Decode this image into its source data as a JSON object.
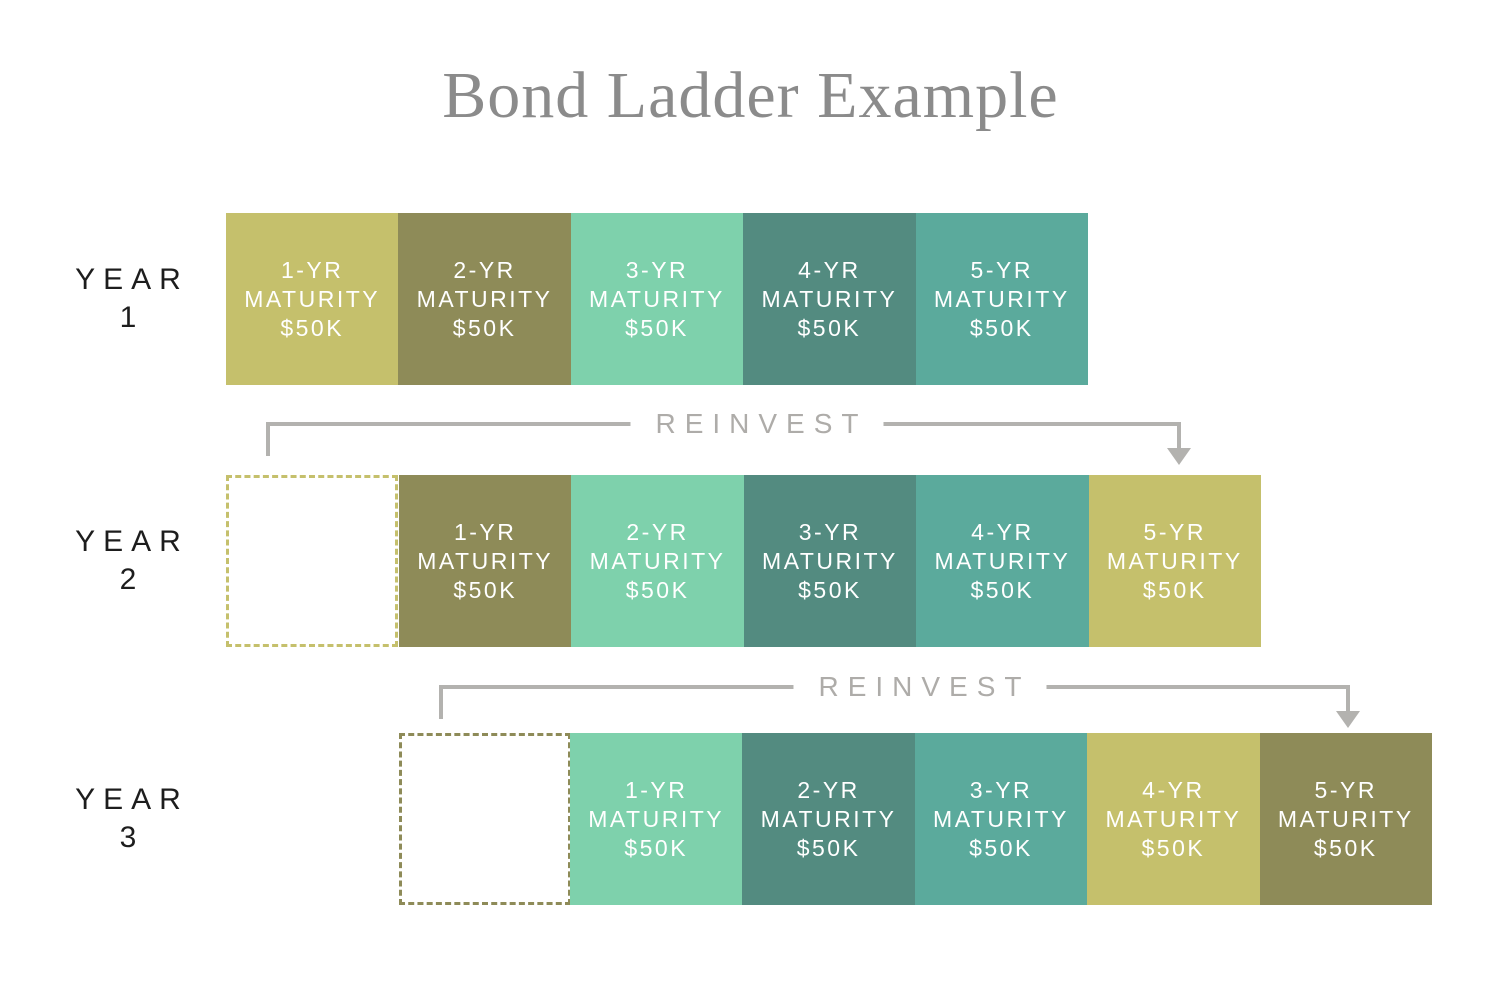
{
  "title": "Bond Ladder Example",
  "palette": {
    "khaki": "#c5c06c",
    "olive": "#8e8b58",
    "mint": "#7ed1ac",
    "teal_dark": "#538b80",
    "teal_medium": "#5baa9c",
    "arrow_gray": "#b3b2af",
    "reinvest_text_gray": "#aeaca9",
    "title_gray": "#8b8b8b",
    "year_label_color": "#1d1d1d",
    "block_text_color": "#ffffff",
    "background": "#ffffff"
  },
  "reinvest_arrows": [
    {
      "label": "REINVEST"
    },
    {
      "label": "REINVEST"
    }
  ],
  "years": [
    {
      "label": "YEAR",
      "number": "1",
      "blocks": [
        {
          "term": "1-YR",
          "maturity": "MATURITY",
          "amount": "$50K",
          "color": "#c5c06c"
        },
        {
          "term": "2-YR",
          "maturity": "MATURITY",
          "amount": "$50K",
          "color": "#8e8b58"
        },
        {
          "term": "3-YR",
          "maturity": "MATURITY",
          "amount": "$50K",
          "color": "#7ed1ac"
        },
        {
          "term": "4-YR",
          "maturity": "MATURITY",
          "amount": "$50K",
          "color": "#538b80"
        },
        {
          "term": "5-YR",
          "maturity": "MATURITY",
          "amount": "$50K",
          "color": "#5baa9c"
        }
      ]
    },
    {
      "label": "YEAR",
      "number": "2",
      "matured_box": {
        "border_color": "#c5c06c"
      },
      "blocks": [
        {
          "term": "1-YR",
          "maturity": "MATURITY",
          "amount": "$50K",
          "color": "#8e8b58"
        },
        {
          "term": "2-YR",
          "maturity": "MATURITY",
          "amount": "$50K",
          "color": "#7ed1ac"
        },
        {
          "term": "3-YR",
          "maturity": "MATURITY",
          "amount": "$50K",
          "color": "#538b80"
        },
        {
          "term": "4-YR",
          "maturity": "MATURITY",
          "amount": "$50K",
          "color": "#5baa9c"
        },
        {
          "term": "5-YR",
          "maturity": "MATURITY",
          "amount": "$50K",
          "color": "#c5c06c"
        }
      ]
    },
    {
      "label": "YEAR",
      "number": "3",
      "matured_box": {
        "border_color": "#8e8b58"
      },
      "blocks": [
        {
          "term": "1-YR",
          "maturity": "MATURITY",
          "amount": "$50K",
          "color": "#7ed1ac"
        },
        {
          "term": "2-YR",
          "maturity": "MATURITY",
          "amount": "$50K",
          "color": "#538b80"
        },
        {
          "term": "3-YR",
          "maturity": "MATURITY",
          "amount": "$50K",
          "color": "#5baa9c"
        },
        {
          "term": "4-YR",
          "maturity": "MATURITY",
          "amount": "$50K",
          "color": "#c5c06c"
        },
        {
          "term": "5-YR",
          "maturity": "MATURITY",
          "amount": "$50K",
          "color": "#8e8b58"
        }
      ]
    }
  ]
}
